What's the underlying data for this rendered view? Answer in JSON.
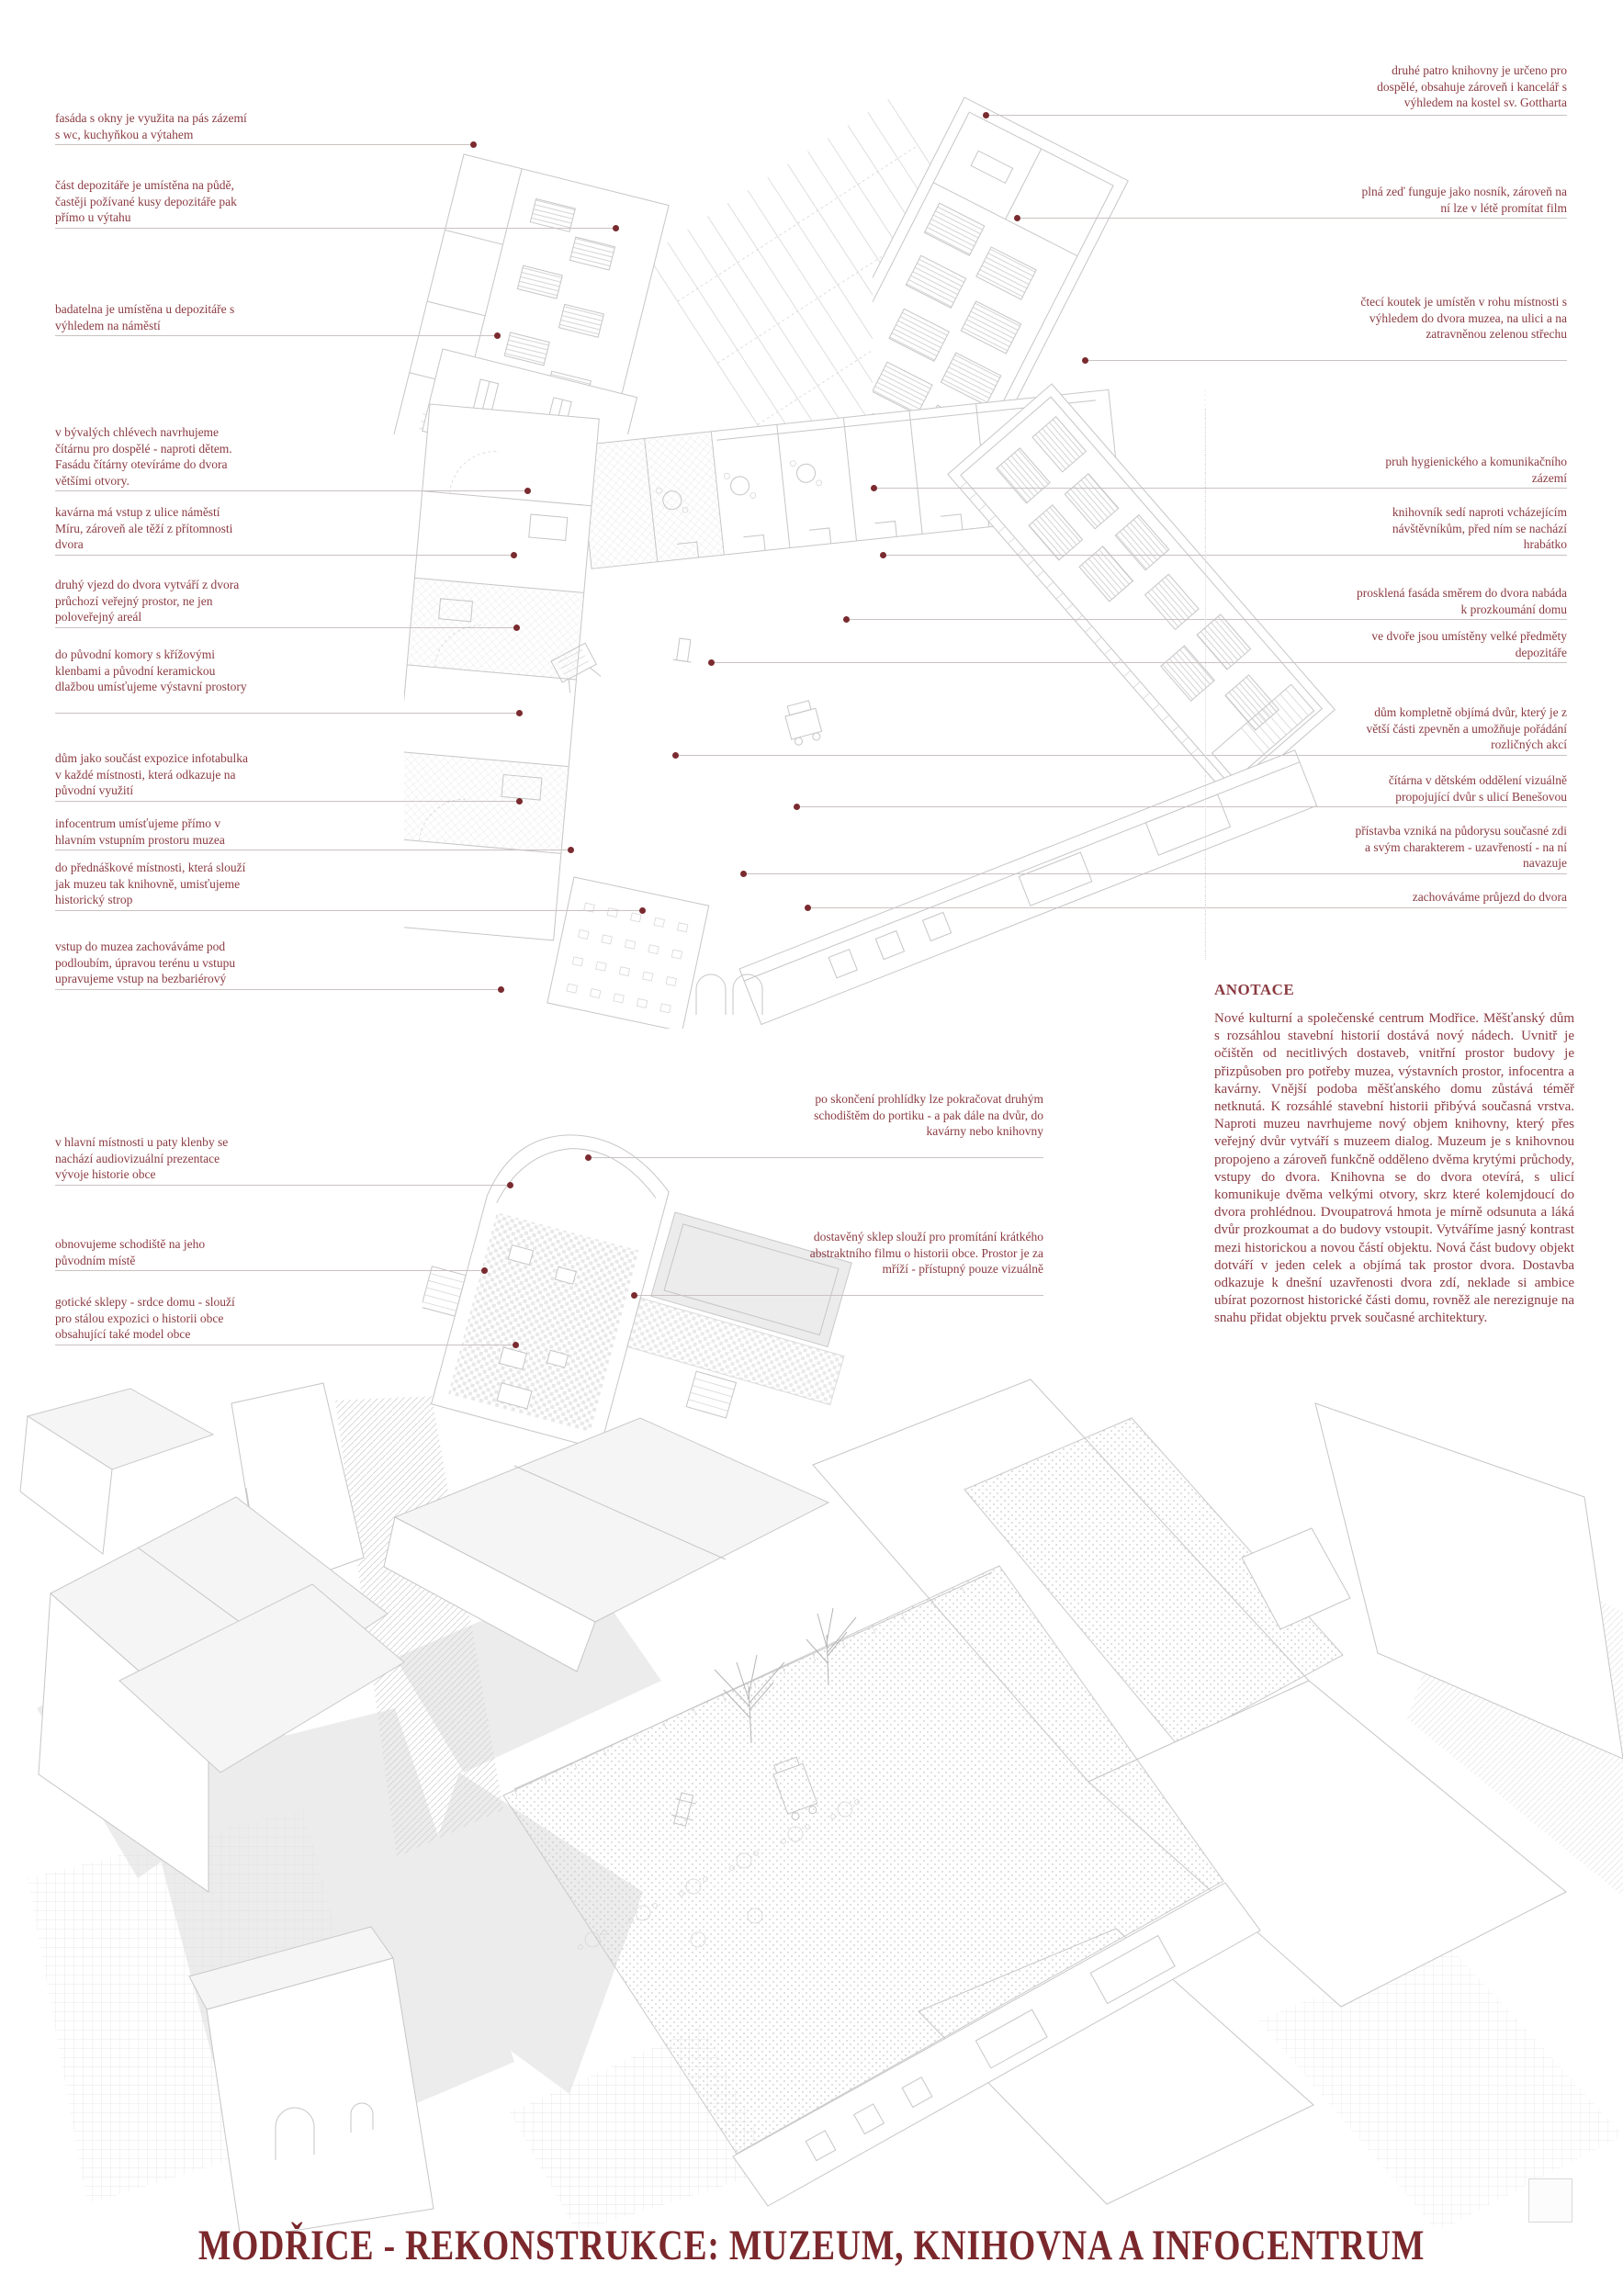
{
  "poster": {
    "title": "MODŘICE - REKONSTRUKCE: MUZEUM, KNIHOVNA A INFOCENTRUM"
  },
  "colors": {
    "annotation_text": "#8a3b41",
    "title_text": "#7b282c",
    "leader_dot": "#7a2b2f",
    "leader_line": "#c9c2c0",
    "drawing_line": "#c6c6c6"
  },
  "annotations": {
    "left": [
      "fasáda s okny je využita na pás zázemí s wc, kuchyňkou a výtahem",
      "část depozitáře je umístěna na půdě, častěji požívané kusy depozitáře pak přímo u výtahu",
      "badatelna je umístěna u depozitáře s výhledem na náměstí",
      "v bývalých chlévech navrhujeme čítárnu pro dospělé - naproti dětem. Fasádu čítárny otevíráme do dvora většími otvory.",
      "kavárna má vstup z ulice náměstí Míru, zároveň ale těží z přítomnosti dvora",
      "druhý vjezd do dvora vytváří z dvora průchozí veřejný prostor, ne jen poloveřejný areál",
      "do původní komory s křížovými klenbami a původní keramickou dlažbou umísťujeme výstavní prostory",
      "dům jako součást expozice infotabulka v každé místnosti, která odkazuje na původní využití",
      "infocentrum umísťujeme přímo v hlavním vstupním prostoru muzea",
      "do přednáškové místnosti, která slouží jak muzeu tak knihovně, umisťujeme historický strop",
      "vstup do muzea zachováváme pod podloubím, úpravou terénu u vstupu upravujeme vstup na bezbariérový",
      "v hlavní místnosti u paty klenby se nachází audiovizuální prezentace vývoje historie obce",
      "obnovujeme schodiště na jeho původním místě",
      "gotické sklepy - srdce domu - slouží pro stálou expozici o historii obce obsahující také model obce"
    ],
    "middle": [
      "po skončení prohlídky lze pokračovat druhým schodištěm do portiku - a pak dále na dvůr, do kavárny nebo knihovny",
      "dostavěný sklep slouží pro promítání krátkého abstraktního filmu o historii obce. Prostor je za mříží - přístupný pouze vizuálně"
    ],
    "right": [
      "druhé patro knihovny je určeno pro dospělé, obsahuje zároveň i kancelář s výhledem na kostel sv. Gottharta",
      "plná zeď funguje jako nosník, zároveň na ní lze v létě promítat film",
      "čtecí koutek je umístěn v rohu místnosti s výhledem do dvora muzea, na ulici a na zatravněnou zelenou střechu",
      "pruh hygienického a komunikačního zázemí",
      "knihovník sedí naproti vcházejícím návštěvníkům, před ním se nachází hrabátko",
      "prosklená fasáda směrem do dvora nabáda k prozkoumání domu",
      "ve dvoře jsou umístěny velké předměty depozitáře",
      "dům kompletně objímá dvůr, který je z větší části zpevněn a umožňuje pořádání rozličných akcí",
      "čítárna v dětském oddělení vizuálně propojující dvůr s ulicí Benešovou",
      "přístavba vzniká na půdorysu současné zdi a svým charakterem - uzavřeností - na ní navazuje",
      "zachováváme průjezd do dvora"
    ]
  },
  "anotace": {
    "heading": "ANOTACE",
    "body": "Nové kulturní a společenské centrum Modřice. Měšťanský dům s rozsáhlou stavební historií dostává nový nádech. Uvnitř je očištěn od necitlivých dostaveb, vnitřní prostor budovy je přizpůsoben pro potřeby muzea, výstavních prostor, infocentra a kavárny. Vnější podoba měšťanského domu zůstává téměř netknutá. K rozsáhlé stavební historii přibývá současná vrstva. Naproti muzeu navrhujeme nový objem knihovny, který přes veřejný dvůr vytváří s muzeem dialog. Muzeum je s knihovnou propojeno a zároveň funkčně odděleno dvěma krytými průchody, vstupy do dvora. Knihovna se do dvora otevírá, s ulicí komunikuje dvěma velkými otvory, skrz které kolemjdoucí do dvora prohlédnou. Dvoupatrová hmota je mírně odsunuta a láká dvůr prozkoumat a do budovy vstoupit. Vytváříme jasný kontrast mezi historickou a novou částí objektu. Nová část budovy objekt dotváří v jeden celek a objímá tak prostor dvora. Dostavba odkazuje k dnešní uzavřenosti dvora zdí, neklade si ambice ubírat pozornost historické části domu, rovněž ale nerezignuje na snahu přidat objektu prvek současné architektury."
  }
}
